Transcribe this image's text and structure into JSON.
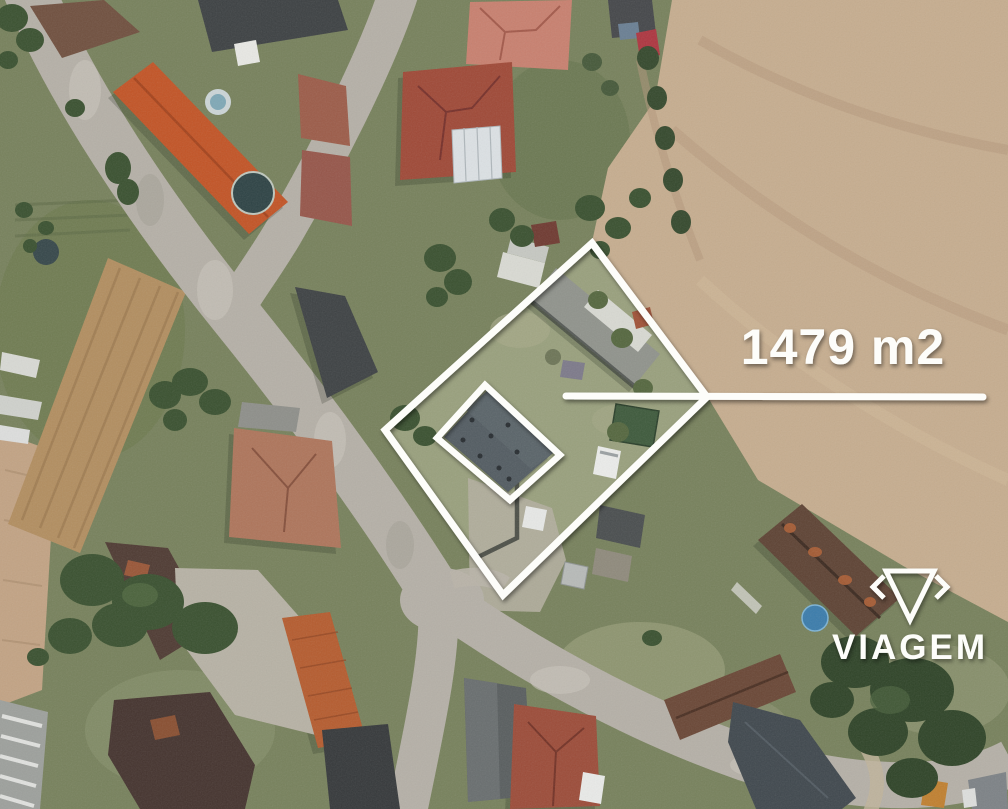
{
  "scene": {
    "description": "Aerial satellite photo of a village with a highlighted parcel for sale",
    "parcel_outlined": true,
    "house_outlined": true
  },
  "annotation": {
    "area_label": "1479 m2",
    "line_color": "#fdfdfa"
  },
  "watermark": {
    "brand": "VIAGEM",
    "icon": "viagem-gem-icon",
    "color": "#fdfdfa"
  },
  "palette": {
    "field_tan": "#c6ad8f",
    "grass_green": "#77815c",
    "road_gray": "#b5b0a7",
    "roof_orange": "#c25426",
    "roof_terracotta": "#ae755b",
    "roof_slate": "#535c62",
    "tree_green": "#3a5130",
    "annotation_white": "#fdfdfa"
  }
}
